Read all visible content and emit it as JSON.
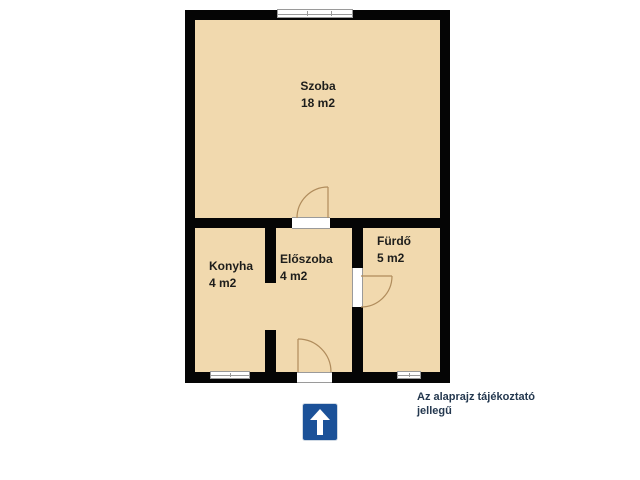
{
  "rooms": {
    "szoba": {
      "name": "Szoba",
      "area": "18 m2"
    },
    "konyha": {
      "name": "Konyha",
      "area": "4 m2"
    },
    "eloszoba": {
      "name": "Előszoba",
      "area": "4 m2"
    },
    "furdo": {
      "name": "Fürdő",
      "area": "5 m2"
    }
  },
  "caption": {
    "line1": "Az alaprajz tájékoztató",
    "line2": "jellegű"
  },
  "icons": {
    "north_sign": "up-arrow-icon"
  },
  "colors": {
    "background": "#ffffff",
    "floor": "#f1d9ae",
    "wall": "#050505",
    "room_text": "#1d1d1b",
    "caption_text": "#24384f",
    "sign_background": "#1b5198",
    "sign_arrow": "#ffffff",
    "door_line": "#b08c5c",
    "window_line": "#9a9a9a"
  }
}
